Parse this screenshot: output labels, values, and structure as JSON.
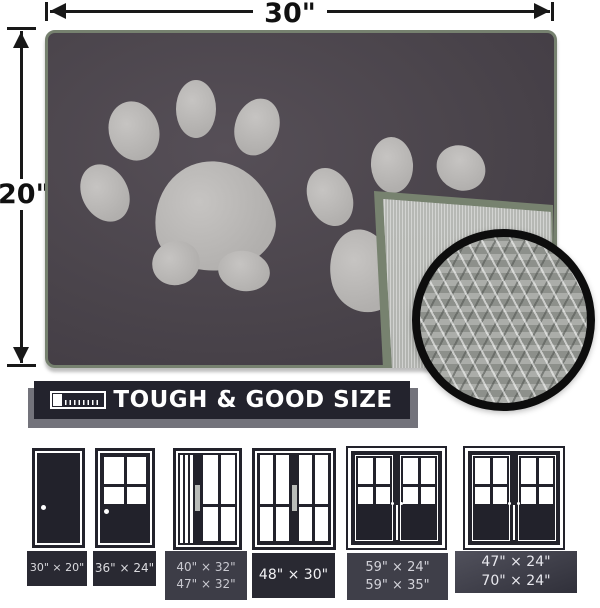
{
  "dimension_labels": {
    "width": "30\"",
    "height": "20\""
  },
  "banner": {
    "label": "TOUGH & GOOD SIZE"
  },
  "size_chart": {
    "items": [
      {
        "sizes": [
          "30\" × 20\""
        ]
      },
      {
        "sizes": [
          "36\" × 24\""
        ]
      },
      {
        "sizes": [
          "40\" × 32\"",
          "47\" × 32\""
        ]
      },
      {
        "sizes": [
          "48\" × 30\""
        ]
      },
      {
        "sizes": [
          "59\" × 24\"",
          "59\" × 35\""
        ]
      },
      {
        "sizes": [
          "47\" × 24\"",
          "70\" × 24\""
        ]
      }
    ]
  },
  "colors": {
    "mat": "#4a444b",
    "paw_print": "#b6b4b3",
    "edge_binding": "#76816f",
    "backing": "#b3b5b1",
    "banner_background": "#23232d"
  }
}
